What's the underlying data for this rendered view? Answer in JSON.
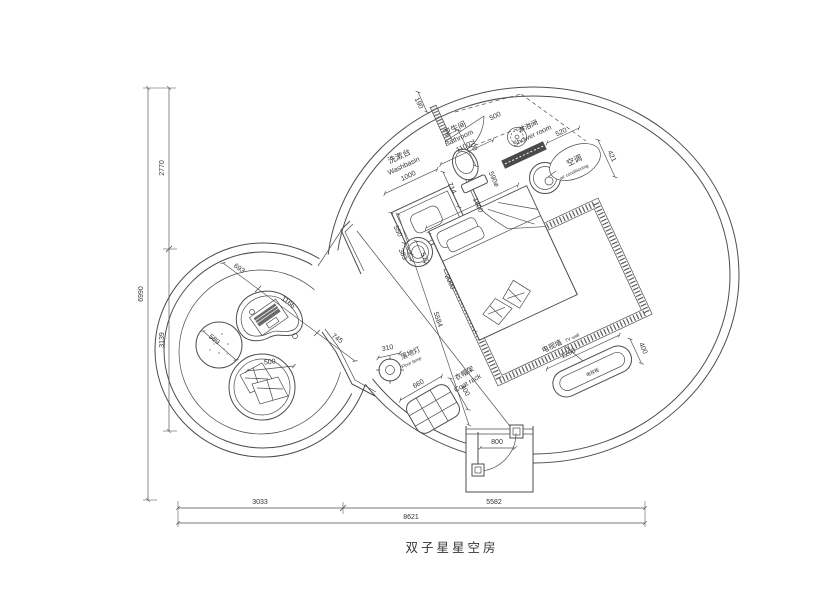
{
  "title": "双子星星空房",
  "colors": {
    "line": "#4d4d4d",
    "text": "#333333",
    "dark_fill": "#4a4a4a",
    "background": "#ffffff"
  },
  "rooms": {
    "washbasin": {
      "zh": "洗漱台",
      "en": "Washbasin",
      "width": "1000"
    },
    "bathroom": {
      "zh": "卫生间",
      "en": "Bathroom",
      "width": "1100"
    },
    "shower": {
      "zh": "淋浴间",
      "en": "Shower room"
    },
    "ac": {
      "zh": "空调",
      "en": "air conditioning",
      "width": "520",
      "depth": "421"
    },
    "floor_lamp": {
      "zh": "落地灯",
      "en": "Floor lamp",
      "dia": "310"
    },
    "coat_rack": {
      "zh": "衣帽架",
      "en": "Coat rack",
      "width": "660",
      "depth": "400"
    },
    "tv": {
      "wall_zh": "电视墙",
      "wall_en": "TV wall",
      "cabinet_zh": "电视柜",
      "width": "1200",
      "depth": "400"
    }
  },
  "dimensions": {
    "overall": {
      "height": "6990",
      "height_upper": "2770",
      "height_lower": "3139",
      "width": "8621",
      "width_left": "3033",
      "width_right": "5582"
    },
    "bathroom": {
      "wall": "190",
      "door": "700",
      "swing": "500",
      "post": "590⌀",
      "gap": "714",
      "counter_depth": "550"
    },
    "bedroom": {
      "bed_width": "1800",
      "bed_length": "2000",
      "room_diag": "5584",
      "stool_a": "383",
      "stool_b": "570",
      "entry_door": "800"
    },
    "lounge": {
      "seg1": "693",
      "seg2": "1166",
      "seg3": "745",
      "pouf": "589",
      "chair": "500"
    }
  }
}
